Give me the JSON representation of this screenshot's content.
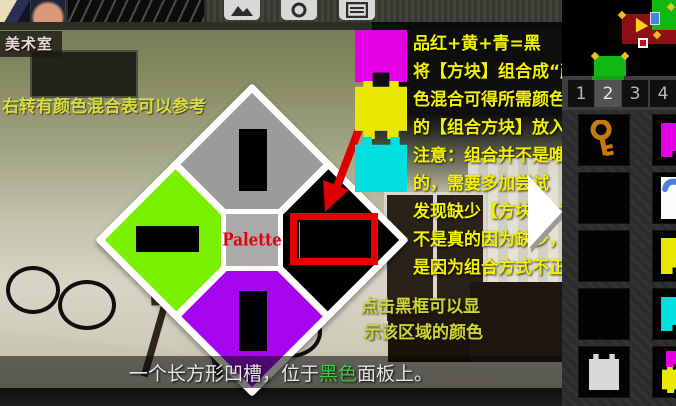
{
  "room": {
    "label": "美术室",
    "left_hint": "右转有颜色混合表可以参考",
    "click_hint_line1": "点击黑框可以显",
    "click_hint_line2": "示该区域的颜色"
  },
  "caption": {
    "pre": "一个长方形凹槽，位于",
    "highlight": "黑色",
    "post": "面板上。",
    "highlight_color": "#3ecb3e"
  },
  "toolbar": {
    "icons": [
      "gallery-icon",
      "camera-icon",
      "notes-icon"
    ]
  },
  "instructions": {
    "text_color": "#f2f200",
    "lines": [
      "品红+黄+青=黑",
      "将【方块】组合成“颜",
      "色混合可得所需颜色”",
      "的【组合方块】放入",
      "注意：组合并不是唯一",
      "的，需要多加尝试",
      "发现缺少【方块】，并",
      "不是真的因为缺少，而",
      "是因为组合方式不正确"
    ]
  },
  "piece_stack": [
    {
      "color_name": "magenta",
      "hex": "#e400e4"
    },
    {
      "color_name": "yellow",
      "hex": "#e8e800"
    },
    {
      "color_name": "cyan",
      "hex": "#00dede"
    }
  ],
  "palette": {
    "label": "Palette",
    "label_color": "#e00010",
    "quadrants": [
      {
        "position": "top",
        "color": "#9b9b9b"
      },
      {
        "position": "right",
        "color": "#000000"
      },
      {
        "position": "left",
        "color": "#78f000"
      },
      {
        "position": "bottom",
        "color": "#a705f0"
      }
    ],
    "highlight_color": "#e80000"
  },
  "side_panel": {
    "tabs": [
      {
        "label": "1",
        "selected": false
      },
      {
        "label": "2",
        "selected": true
      },
      {
        "label": "3",
        "selected": false
      },
      {
        "label": "4",
        "selected": false
      }
    ],
    "selected_indicator_color": "#17a317",
    "item_colors": {
      "magenta-piece": "#e400e4",
      "yellow-piece": "#e8e800",
      "cyan-piece": "#00dede",
      "silver-piece": "#d8d8d8",
      "key": "#c87a10",
      "note-ink": "#4a82d8"
    },
    "inventory_columns": [
      {
        "slots": [
          "key",
          null,
          null,
          null,
          "silver-piece"
        ]
      },
      {
        "slots": [
          "magenta-piece",
          "paper-note",
          "yellow-piece",
          "cyan-piece",
          "magenta-yellow-piece"
        ]
      }
    ],
    "minimap": {
      "room_color": "#8e1016",
      "arrow_color": "#ffd21c",
      "object_color": "#12b812",
      "marker_color": "#e8c020"
    }
  }
}
